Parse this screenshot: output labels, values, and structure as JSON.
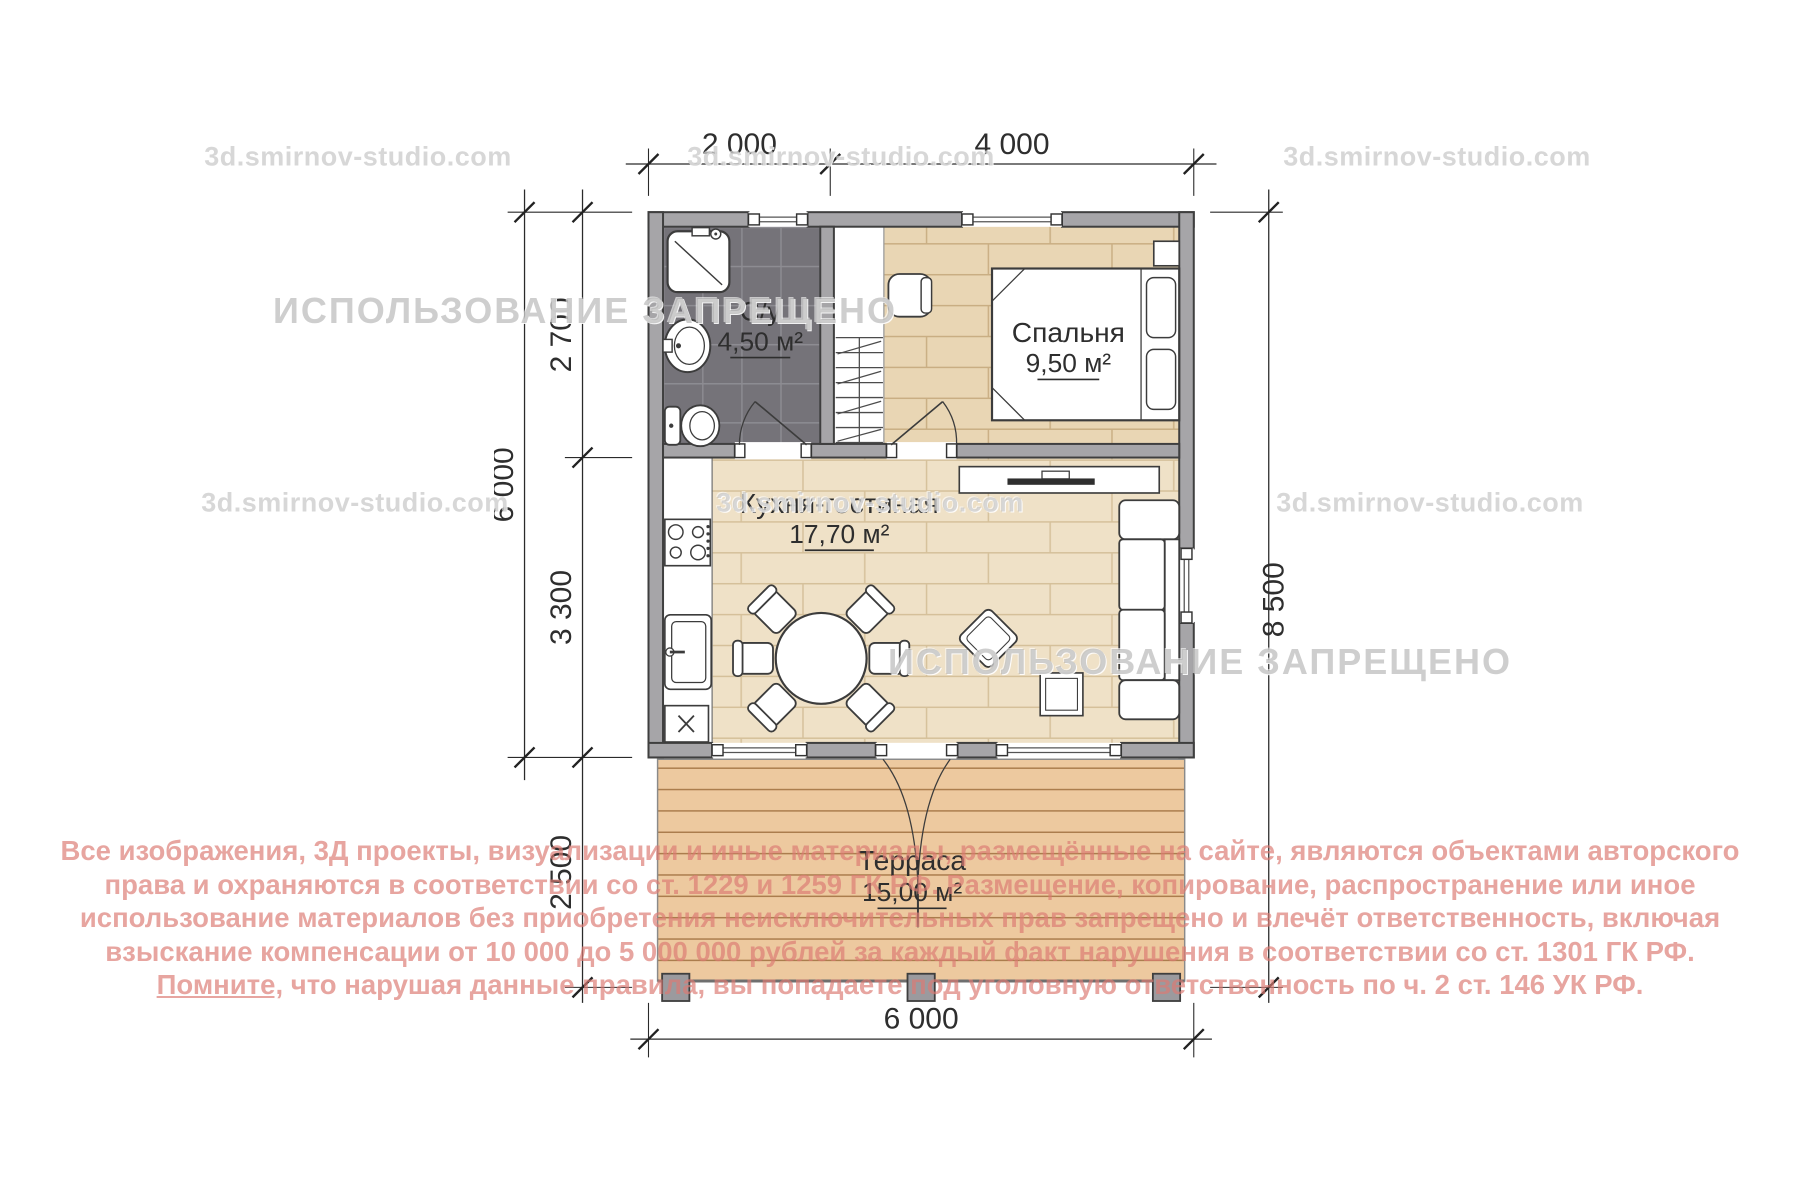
{
  "watermarks": {
    "site": "3d.smirnov-studio.com",
    "forbidden": "ИСПОЛЬЗОВАНИЕ ЗАПРЕЩЕНО"
  },
  "dimensions": {
    "top_left": "2 000",
    "top_right": "4 000",
    "left_upper": "2 700",
    "left_lower": "3 300",
    "left_total": "6 000",
    "left_terrace": "2 500",
    "right_total": "8 500",
    "bottom_total": "6 000"
  },
  "rooms": {
    "bathroom": {
      "name": "С/у",
      "area": "4,50 м²"
    },
    "bedroom": {
      "name": "Спальня",
      "area": "9,50 м²"
    },
    "kitchen": {
      "name": "Кухня-гостиная",
      "area": "17,70 м²"
    },
    "terrace": {
      "name": "Терраса",
      "area": "15,00 м²"
    }
  },
  "copyright": {
    "line1": "Все изображения, 3Д проекты, визуализации и иные материалы, размещённые на сайте, являются объектами авторского",
    "line2": "права и охраняются в соответствии со ст. 1229 и 1259 ГК РФ. Размещение, копирование, распространение или иное",
    "line3": "использование материалов без приобретения неисключительных прав запрещено и влечёт ответственность, включая",
    "line4": "взыскание компенсации от 10 000 до 5 000 000 рублей за каждый факт нарушения в соответствии со ст. 1301 ГК РФ.",
    "line5_underlined": "Помните,",
    "line5_rest": " что нарушая данные правила, вы попадаете под уголовную ответственность по ч. 2 ст. 146 УК РФ."
  },
  "colors": {
    "wall": "#a6a5a8",
    "bath_tile": "#757379",
    "wood_bedroom": "#e9d6b4",
    "wood_living": "#efe1c7",
    "terrace_deck": "#edc99f",
    "copyright_pink": "#db7b73",
    "watermark_gray": "#a5a5a5"
  }
}
